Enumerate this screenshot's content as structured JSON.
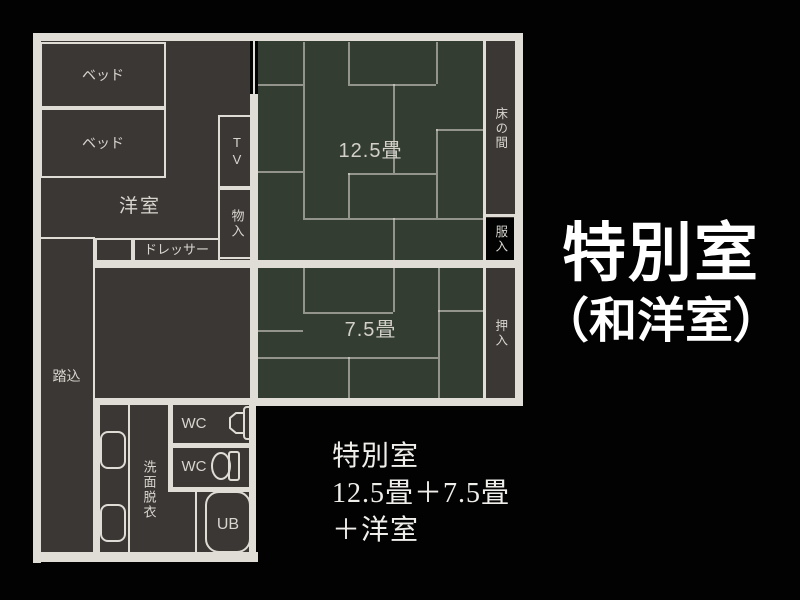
{
  "title": {
    "line1": "特別室",
    "line2": "（和洋室）"
  },
  "description": {
    "line1": "特別室",
    "line2": "12.5畳＋7.5畳",
    "line3": "＋洋室"
  },
  "floorplan": {
    "rooms": {
      "western_room": "洋室",
      "bed1": "ベッド",
      "bed2": "ベッド",
      "tv": "TV",
      "storage": "物入",
      "dresser": "ドレッサー",
      "tatami_large": "12.5畳",
      "tokonoma": "床の間",
      "clothes_closet": "服入",
      "tatami_small": "7.5畳",
      "futon_closet": "押入",
      "entrance": "踏込",
      "wc1": "WC",
      "wc2": "WC",
      "washroom": "洗面脱衣",
      "unit_bath": "UB"
    },
    "colors": {
      "background": "#020202",
      "room_fill": "#3b3735",
      "tatami_fill": "#333d31",
      "wall": "#e0ddd7",
      "label_text": "#d8d5cf",
      "title_text": "#ffffff"
    }
  }
}
